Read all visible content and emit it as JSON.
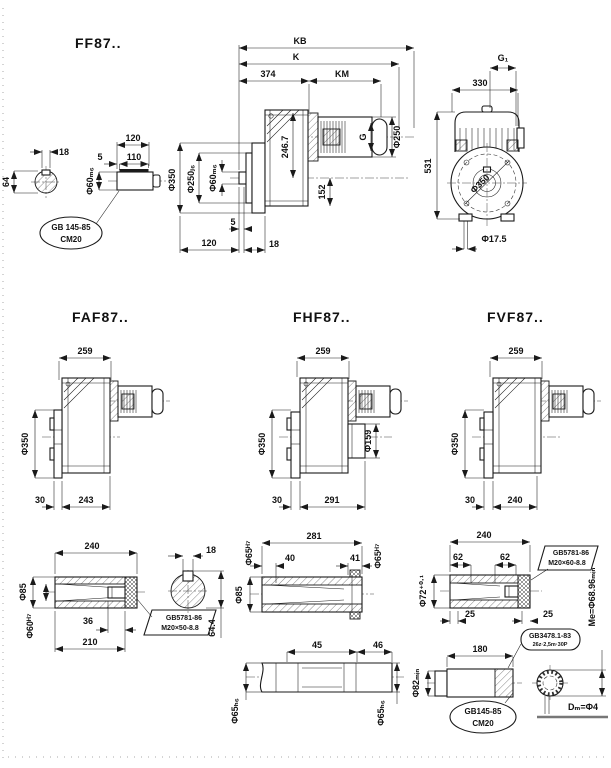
{
  "sheet": {
    "bg": "#ffffff",
    "ink": "#1a1a1a"
  },
  "ff87": {
    "title": "FF87..",
    "key_section": {
      "w18": "18",
      "h64": "64"
    },
    "shaft": {
      "l120": "120",
      "l110": "110",
      "l5": "5",
      "dia": "Φ60ₘ₆",
      "callout1": "GB 145-85",
      "callout2": "CM20"
    },
    "front": {
      "kb": "KB",
      "k": "K",
      "l374": "374",
      "km": "KM",
      "dia350": "Φ350",
      "dia250": "Φ250ⱼ₆",
      "dia60": "Φ60ₘ₆",
      "h246": "246.7",
      "h152": "152",
      "g": "G",
      "diam250": "Φ250",
      "b120": "120",
      "b5": "5",
      "b18": "18"
    },
    "side": {
      "g1": "G₁",
      "w330": "330",
      "h531": "531",
      "dia350": "Φ350",
      "hole": "Φ17.5"
    }
  },
  "faf87": {
    "title": "FAF87..",
    "w259": "259",
    "dia350": "Φ350",
    "b30": "30",
    "b243": "243"
  },
  "fhf87": {
    "title": "FHF87..",
    "w259": "259",
    "dia350": "Φ350",
    "dia159": "Φ159",
    "b30": "30",
    "b291": "291"
  },
  "fvf87": {
    "title": "FVF87..",
    "w259": "259",
    "dia350": "Φ350",
    "b30": "30",
    "b240": "240"
  },
  "shaft_a": {
    "l240": "240",
    "dia85": "Φ85",
    "dia60": "Φ60ᴴ⁷",
    "l36": "36",
    "l210": "210",
    "bolt1": "GB5781-86",
    "bolt2": "M20×50-8.8",
    "w18": "18",
    "h644": "64.4"
  },
  "shaft_b": {
    "l281": "281",
    "l40": "40",
    "l41": "41",
    "dia65l": "Φ65ᴴ⁷",
    "dia65r": "Φ65ᴴ⁷",
    "dia85": "Φ85",
    "l45": "45",
    "l46": "46",
    "dia65hl": "Φ65ₕ₆",
    "dia65hr": "Φ65ₕ₆"
  },
  "shaft_c": {
    "l240": "240",
    "l62l": "62",
    "l62r": "62",
    "dia72": "Φ72⁺⁰·¹",
    "l25l": "25",
    "l25r": "25",
    "bolt1": "GB5781-86",
    "bolt2": "M20×60-8.8",
    "l180": "180",
    "dia82": "Φ82ₘᵢₙ",
    "spline1": "GB3478.1-83",
    "spline2": "26z·2,5m·30P",
    "center1": "GB145-85",
    "center2": "CM20",
    "me": "Me=Φ68.96ₘᵢₙ",
    "dm": "Dₘ=Φ4"
  }
}
